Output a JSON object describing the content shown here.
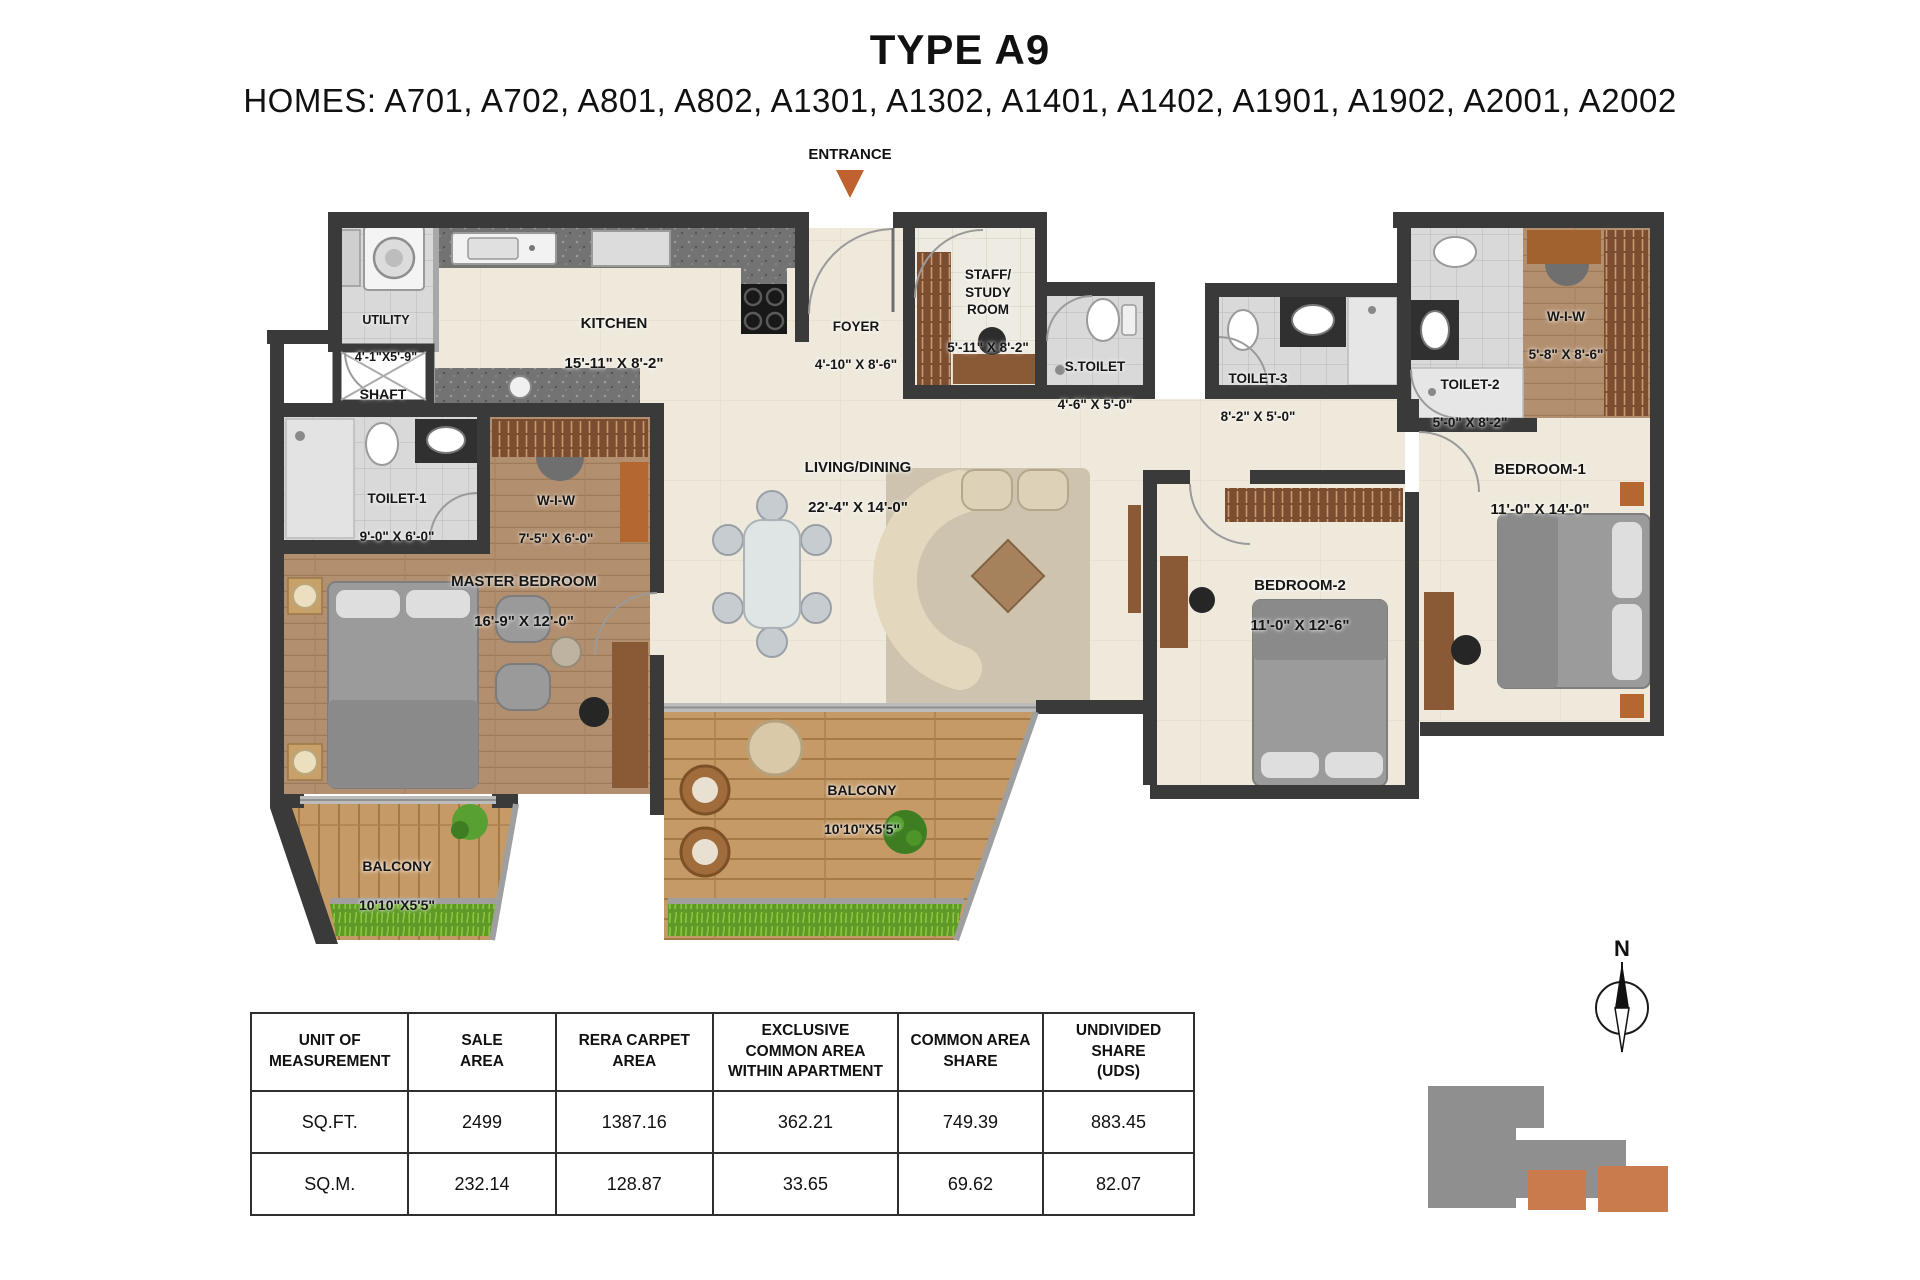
{
  "header": {
    "title": "TYPE A9",
    "homes": "HOMES: A701, A702, A801, A802, A1301, A1302, A1401, A1402, A1901, A1902, A2001, A2002"
  },
  "entrance_label": "ENTRANCE",
  "rooms": {
    "utility": {
      "name": "UTILITY",
      "dims": "4'-1\"X5'-9\""
    },
    "kitchen": {
      "name": "KITCHEN",
      "dims": "15'-11\" X 8'-2\""
    },
    "foyer": {
      "name": "FOYER",
      "dims": "4'-10\" X 8'-6\""
    },
    "staff_study": {
      "name": "STAFF/\nSTUDY\nROOM",
      "dims": "5'-11\" X 8'-2\""
    },
    "s_toilet": {
      "name": "S.TOILET",
      "dims": "4'-6\" X 5'-0\""
    },
    "toilet_3": {
      "name": "TOILET-3",
      "dims": "8'-2\" X 5'-0\""
    },
    "toilet_2": {
      "name": "TOILET-2",
      "dims": "5'-0\" X 8'-2\""
    },
    "wiw_ne": {
      "name": "W-I-W",
      "dims": "5'-8\" X 8'-6\""
    },
    "shaft": {
      "name": "SHAFT"
    },
    "toilet_1": {
      "name": "TOILET-1",
      "dims": "9'-0\" X 6'-0\""
    },
    "wiw_master": {
      "name": "W-I-W",
      "dims": "7'-5\" X 6'-0\""
    },
    "master_bedroom": {
      "name": "MASTER BEDROOM",
      "dims": "16'-9\" X 12'-0\""
    },
    "living_dining": {
      "name": "LIVING/DINING",
      "dims": "22'-4\" X 14'-0\""
    },
    "bedroom_2": {
      "name": "BEDROOM-2",
      "dims": "11'-0\" X 12'-6\""
    },
    "bedroom_1": {
      "name": "BEDROOM-1",
      "dims": "11'-0\" X 14'-0\""
    },
    "balcony_left": {
      "name": "BALCONY",
      "dims": "10'10\"X5'5\""
    },
    "balcony_mid": {
      "name": "BALCONY",
      "dims": "10'10\"X5'5\""
    }
  },
  "compass": {
    "north_label": "N"
  },
  "area_table": {
    "headers": [
      "UNIT OF\nMEASUREMENT",
      "SALE\nAREA",
      "RERA CARPET\nAREA",
      "EXCLUSIVE\nCOMMON AREA\nWITHIN APARTMENT",
      "COMMON AREA\nSHARE",
      "UNDIVIDED SHARE\n(UDS)"
    ],
    "rows": [
      [
        "SQ.FT.",
        "2499",
        "1387.16",
        "362.21",
        "749.39",
        "883.45"
      ],
      [
        "SQ.M.",
        "232.14",
        "128.87",
        "33.65",
        "69.62",
        "82.07"
      ]
    ]
  },
  "colors": {
    "accent_orange": "#C0622F",
    "wall": "#3A3A3A",
    "wood": "#B28F6E",
    "balcony_wood": "#C59A67",
    "grass": "#5F9A28",
    "keyplan_gray": "#8F8F8F",
    "keyplan_orange": "#C97B4E"
  }
}
